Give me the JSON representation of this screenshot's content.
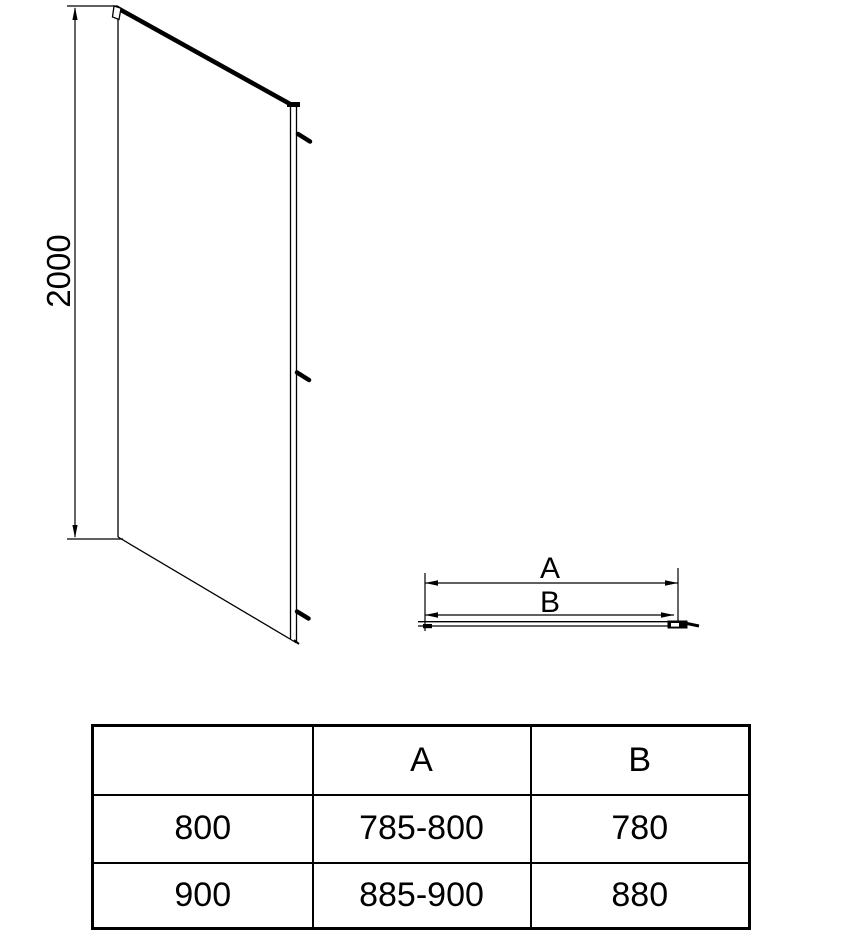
{
  "side_view": {
    "height_dim_label": "2000"
  },
  "top_view": {
    "dim_a_label": "A",
    "dim_b_label": "B"
  },
  "table": {
    "headers": [
      "",
      "A",
      "B"
    ],
    "rows": [
      {
        "size": "800",
        "a": "785-800",
        "b": "780"
      },
      {
        "size": "900",
        "a": "885-900",
        "b": "880"
      }
    ]
  },
  "colors": {
    "line": "#000000",
    "background": "#ffffff"
  }
}
